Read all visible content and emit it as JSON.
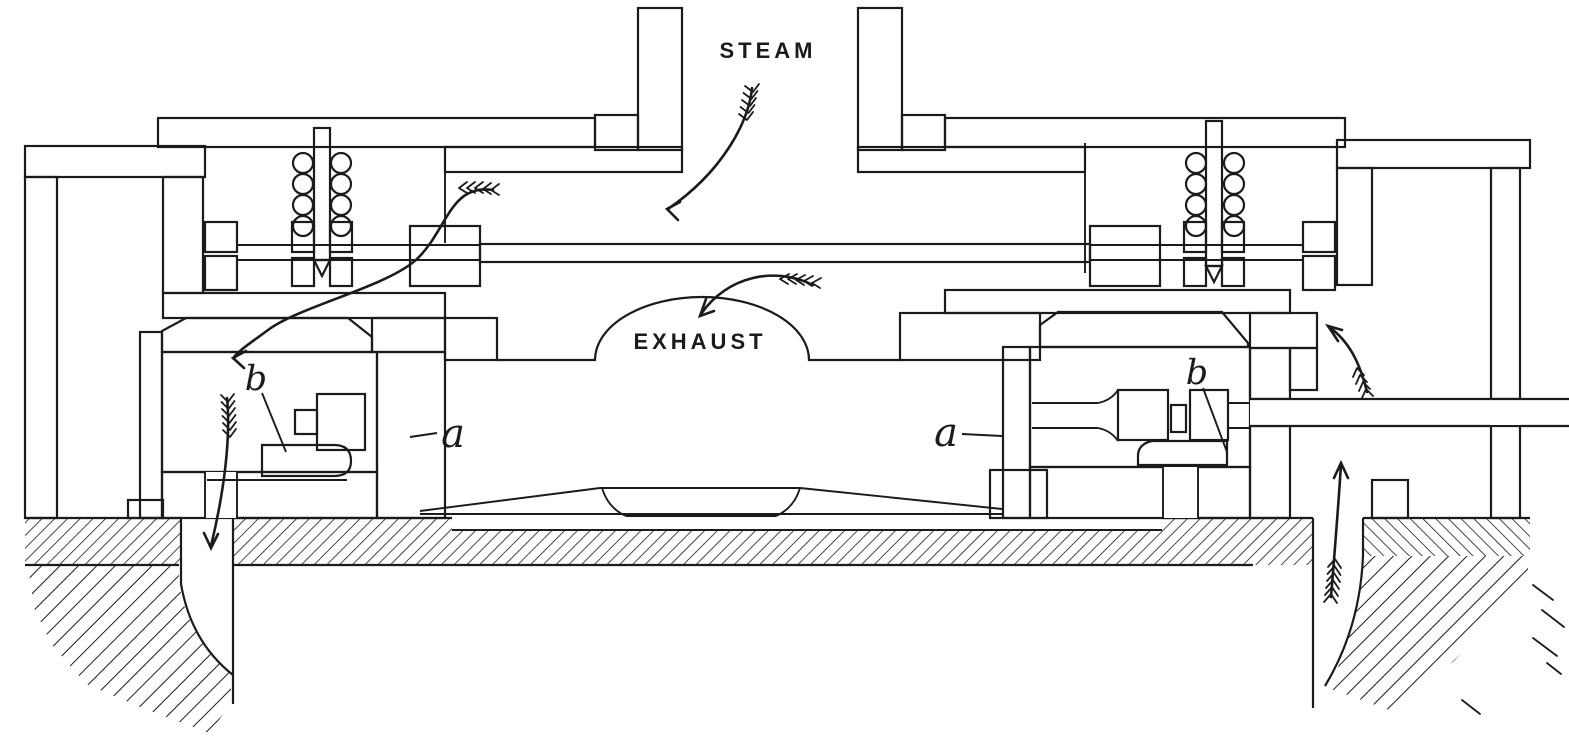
{
  "figure": {
    "colors": {
      "ink": "#1b1b1b",
      "paper": "#ffffff"
    },
    "labels": {
      "steam": "STEAM",
      "exhaust": "EXHAUST",
      "a_left": "a",
      "a_right": "a",
      "b_left": "b",
      "b_right": "b"
    },
    "flow_arrows": [
      {
        "name": "steam-inlet-flow-arrow"
      },
      {
        "name": "exhaust-flow-arrow"
      },
      {
        "name": "steam-to-left-valve-flow-arrow"
      },
      {
        "name": "left-valve-discharge-flow-arrow"
      },
      {
        "name": "right-passage-up-flow-arrow"
      },
      {
        "name": "right-valve-inlet-flow-arrow"
      }
    ]
  }
}
